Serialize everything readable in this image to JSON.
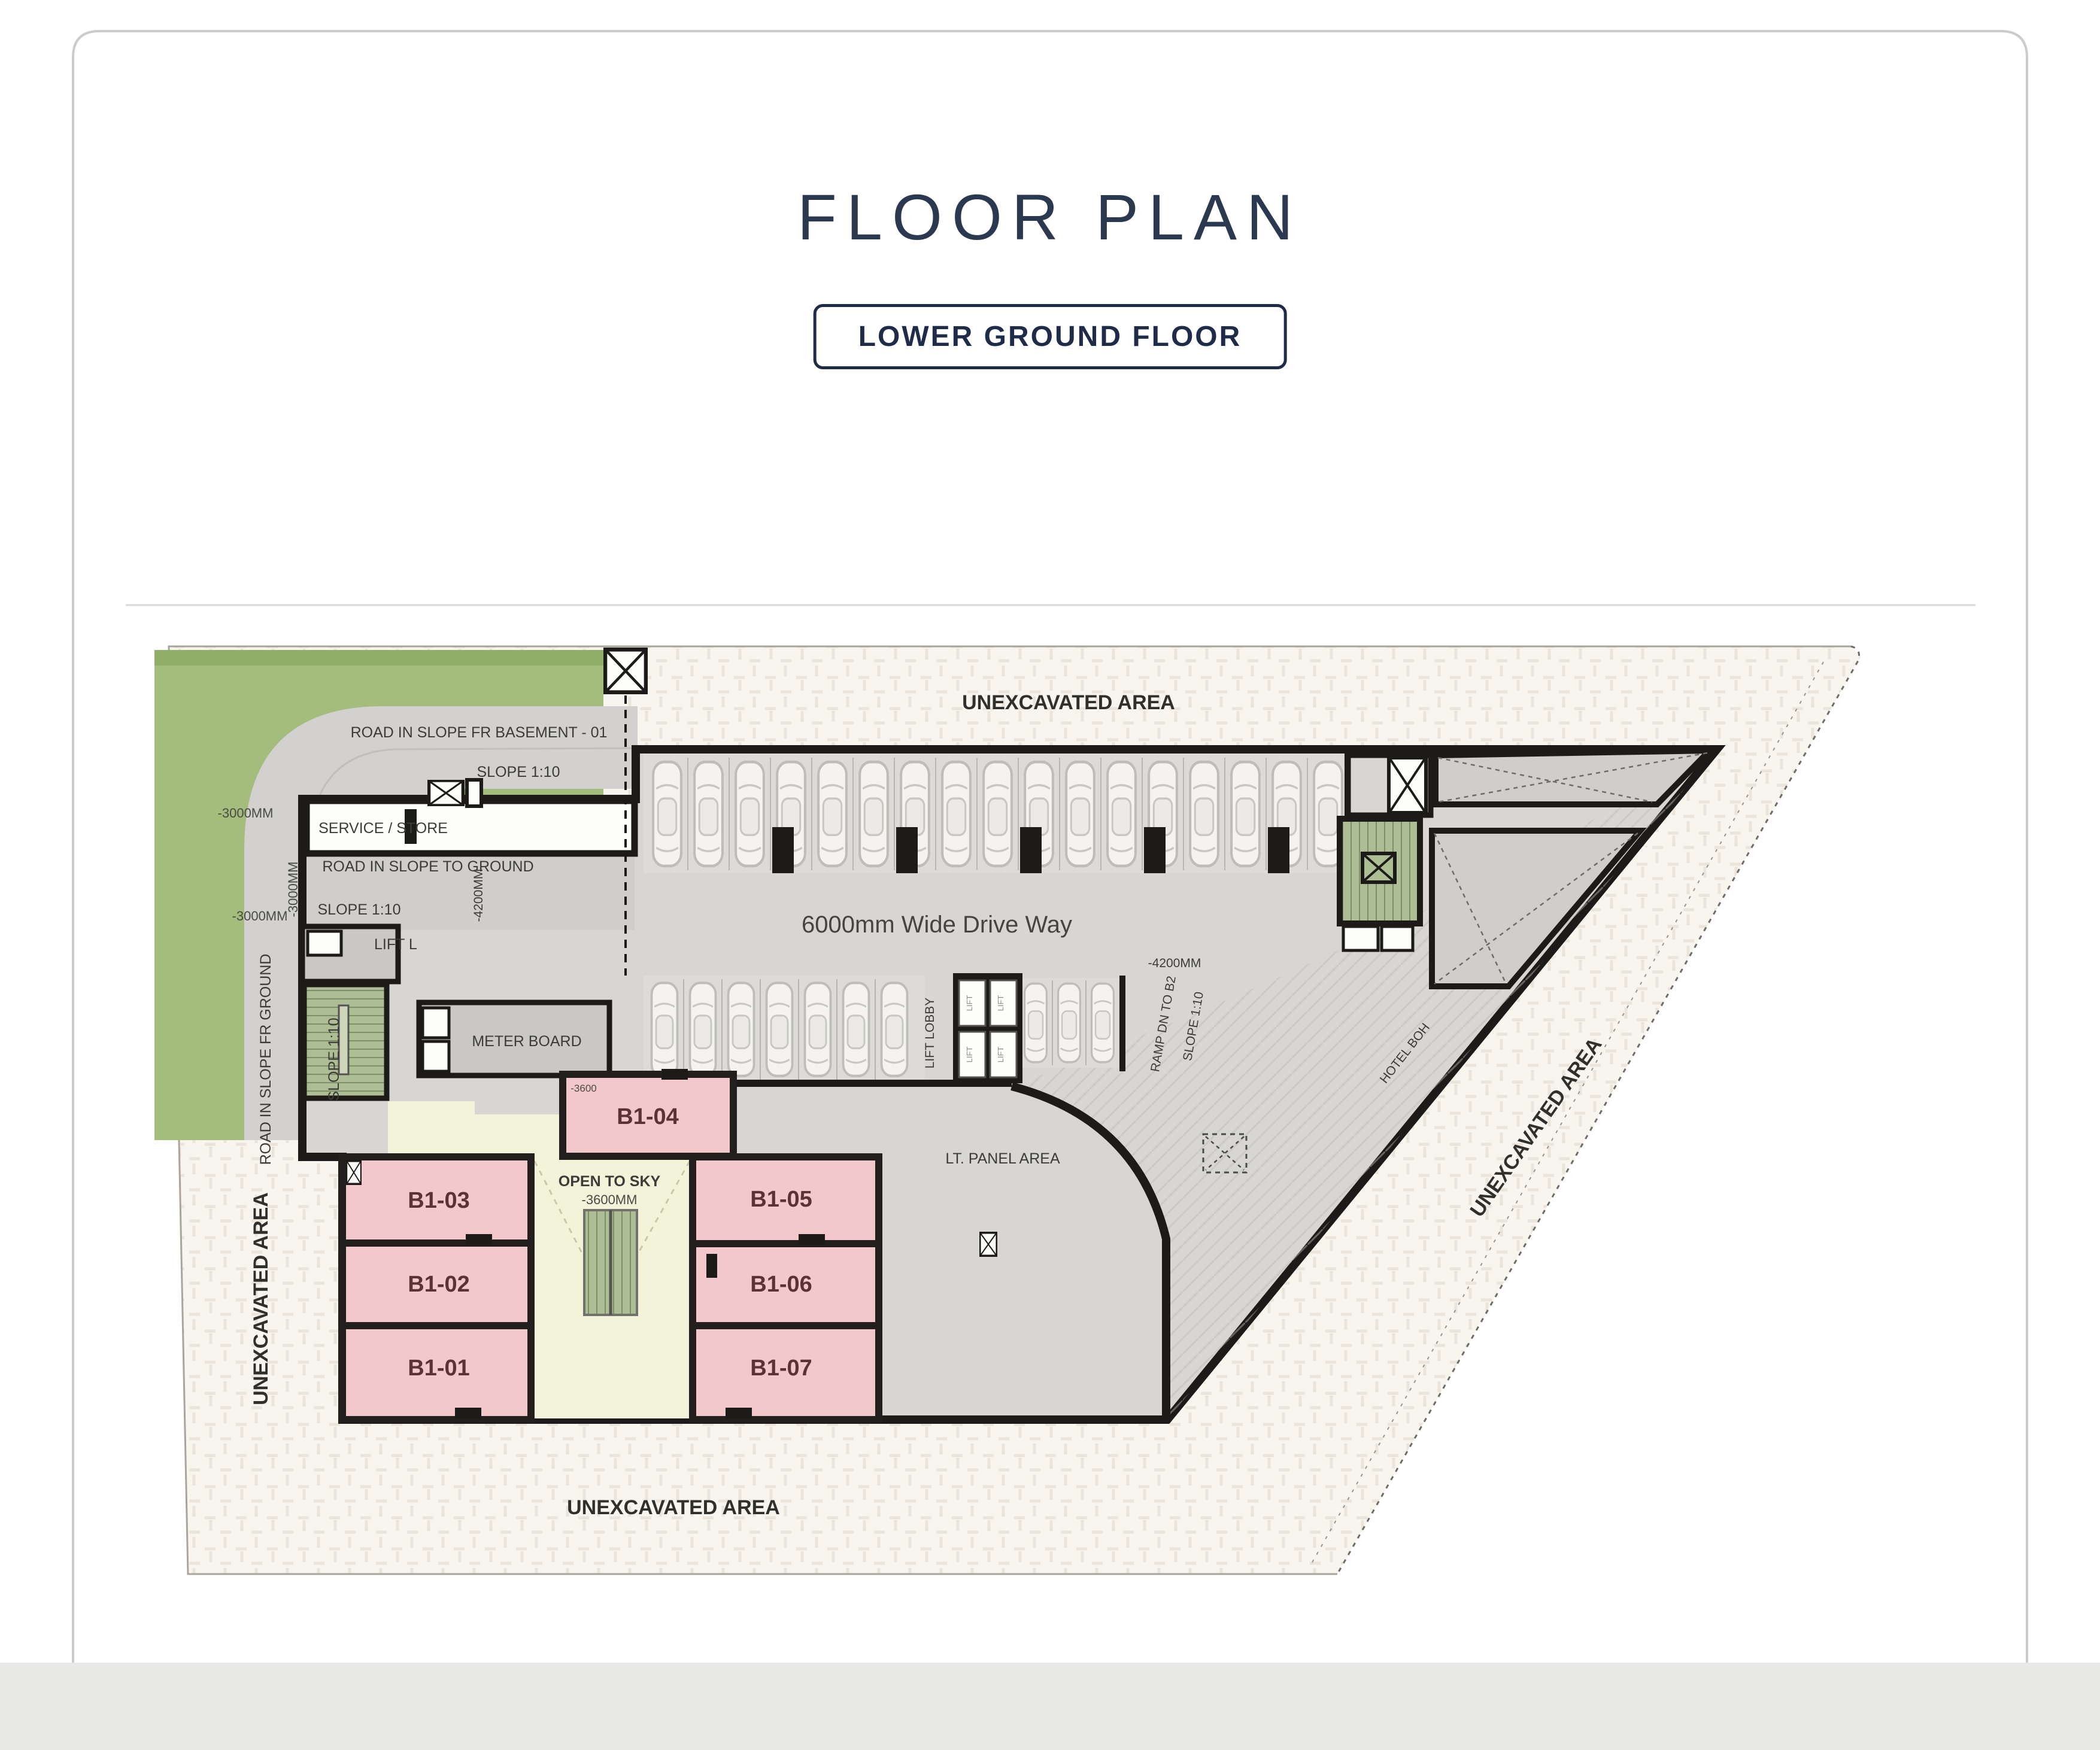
{
  "header": {
    "title": "FLOOR PLAN",
    "floor_label": "LOWER GROUND FLOOR"
  },
  "plan": {
    "areas": {
      "unexcavated": "UNEXCAVATED AREA",
      "service_store": "SERVICE / STORE",
      "meter_board": "METER BOARD",
      "lift_l": "LIFT L",
      "lift_lobby": "LIFT LOBBY",
      "lift": "LIFT",
      "lt_panel": "LT. PANEL AREA",
      "open_to_sky": "OPEN TO SKY",
      "hotel_boh": "HOTEL BOH",
      "drive_way": "6000mm Wide Drive Way"
    },
    "roads": {
      "basement": "ROAD IN SLOPE FR BASEMENT - 01",
      "to_ground": "ROAD IN SLOPE TO GROUND",
      "fr_ground": "ROAD IN SLOPE FR GROUND",
      "ramp_dn": "RAMP DN TO B2",
      "slope": "SLOPE 1:10"
    },
    "levels": {
      "m3000": "-3000MM",
      "m4200": "-4200MM",
      "m3600mm": "-3600MM",
      "m3600": "-3600"
    },
    "units": [
      {
        "id": "B1-01"
      },
      {
        "id": "B1-02"
      },
      {
        "id": "B1-03"
      },
      {
        "id": "B1-04"
      },
      {
        "id": "B1-05"
      },
      {
        "id": "B1-06"
      },
      {
        "id": "B1-07"
      }
    ]
  },
  "colors": {
    "accent_navy": "#1f2c49",
    "unit_pink": "#f3c8ca",
    "landscape_green": "#a4bd7d",
    "courtyard_yellow": "#f3f3d9",
    "stair_green": "#aebe94",
    "wall_black": "#1d1b19",
    "road_gray": "#d2d1cf",
    "site_cream": "#f8f4ee"
  }
}
